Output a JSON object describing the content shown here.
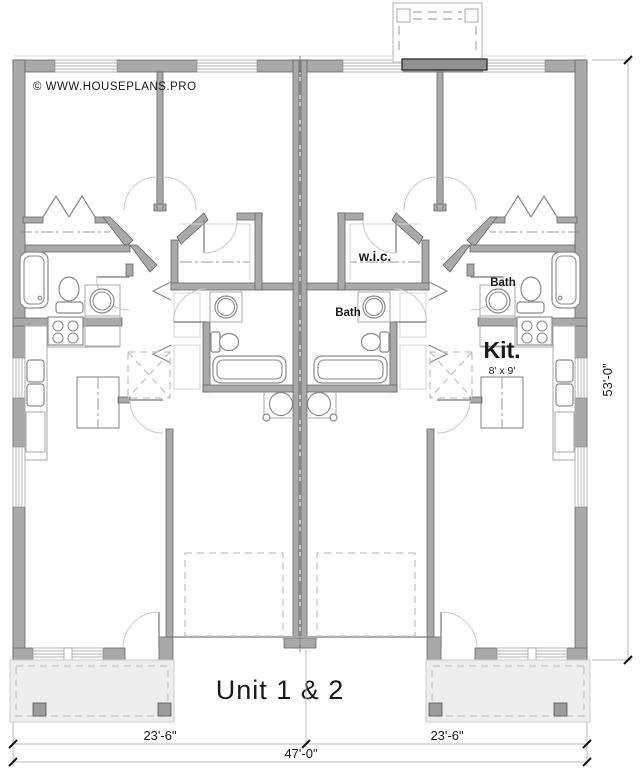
{
  "page": {
    "width": 641,
    "height": 770,
    "background": "#ffffff"
  },
  "branding": {
    "copyright": "© WWW.HOUSEPLANS.PRO"
  },
  "title": {
    "text": "Unit 1 & 2"
  },
  "rooms": {
    "wic_label": "w.i.c.",
    "bath_hall_label": "Bath",
    "bath_main_label": "Bath",
    "kitchen_label": "Kit.",
    "kitchen_size": "8' x 9'"
  },
  "dimensions": {
    "unit1_width": "23'-6\"",
    "unit2_width": "23'-6\"",
    "total_width": "47'-0\"",
    "total_depth": "53'-0\""
  },
  "colors": {
    "wall_gray": "#a9a9a9",
    "fireplace_gray": "#909090",
    "porch_fill": "#ededed",
    "dashed_line_gray": "#c4c4c4",
    "dimension_text": "#1a1a1a",
    "copyright_gray": "#a8a8a8"
  }
}
